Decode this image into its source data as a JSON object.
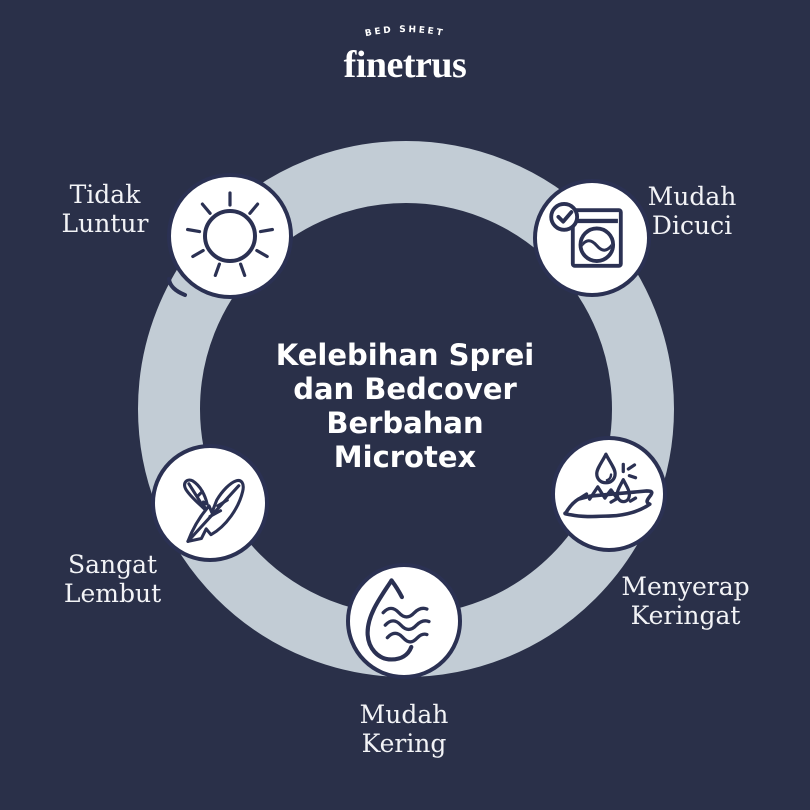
{
  "colors": {
    "background": "#2a3049",
    "ring": "#c2ccd5",
    "navy": "#2b3153",
    "white": "#ffffff",
    "label_text": "#f2f3f6"
  },
  "logo": {
    "tagline": "BED SHEET",
    "brand": "finetrus"
  },
  "center": {
    "title_lines": [
      "Kelebihan Sprei",
      "dan Bedcover",
      "Berbahan",
      "Microtex"
    ]
  },
  "items": [
    {
      "id": "tidak-luntur",
      "label_lines": [
        "Tidak",
        "Luntur"
      ],
      "icon": "sun-icon"
    },
    {
      "id": "mudah-dicuci",
      "label_lines": [
        "Mudah",
        "Dicuci"
      ],
      "icon": "washing-machine-icon"
    },
    {
      "id": "sangat-lembut",
      "label_lines": [
        "Sangat",
        "Lembut"
      ],
      "icon": "feather-icon"
    },
    {
      "id": "mudah-kering",
      "label_lines": [
        "Mudah",
        "Kering"
      ],
      "icon": "drying-drop-icon"
    },
    {
      "id": "menyerap-keringat",
      "label_lines": [
        "Menyerap",
        "Keringat"
      ],
      "icon": "absorb-sweat-icon"
    }
  ]
}
